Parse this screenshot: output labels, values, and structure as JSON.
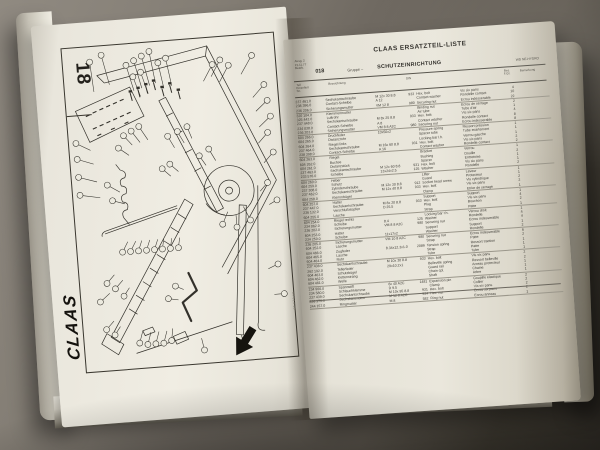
{
  "left_page": {
    "tab_number": "18",
    "brand_logo": "CLAAS",
    "edge_code": "04 013 18"
  },
  "right_page": {
    "title": "CLAAS ERSATZTEIL-LISTE",
    "meta_lines": [
      "Ausg. 2",
      "21.11.77",
      "Bearb."
    ],
    "group_no": "018",
    "group_label": "Gruppe –",
    "group_name": "SCHUTZEINRICHTUNG",
    "right_ref": "WD NE-HYDRO",
    "table": {
      "col_headers": {
        "part_no_lines": [
          "Teil",
          "Einzelteil",
          "Nr."
        ],
        "description": "Bezeichnung",
        "din": "DIN",
        "qty_lines": [
          "Bes.",
          "F.Gr."
        ],
        "remark": "Bemerkung"
      },
      "rows": [
        {
          "nr": "237 461.0",
          "de": "Sechskantschraube",
          "dim": "M 12x 30 8.8",
          "din": "933",
          "en": "Hex. bolt",
          "fr": "Vis six pans",
          "qty": "4",
          "rem": ""
        },
        {
          "nr": "238 396.0",
          "de": "Contact-Scheibe",
          "dim": "A 12",
          "din": "",
          "en": "Contact washer",
          "fr": "Rondelle contact",
          "qty": "10",
          "rem": ""
        },
        {
          "nr": "236 206.0",
          "de": "Sicherungsmutter",
          "dim": "VM 12 8",
          "din": "980",
          "en": "Securing nut",
          "fr": "Ecrou indesserable",
          "qty": "22",
          "rem": "",
          "hr": true
        },
        {
          "nr": "320 104.0",
          "de": "Klemmenmutter",
          "dim": "",
          "din": "",
          "en": "Binding nut",
          "fr": "Ecrou de serrage",
          "qty": "2",
          "rem": ""
        },
        {
          "nr": "325 442.0",
          "de": "Luftrohr",
          "dim": "",
          "din": "",
          "en": "Air tube",
          "fr": "Tube d'air",
          "qty": "1",
          "rem": ""
        },
        {
          "nr": "237 448.0",
          "de": "Sechskantschraube",
          "dim": "M 8x 25 8.8",
          "din": "933",
          "en": "Hex. bolt",
          "fr": "Vis six pans",
          "qty": "4",
          "rem": ""
        },
        {
          "nr": "234 038.0",
          "de": "Contact-Scheibe",
          "dim": "A 8",
          "din": "",
          "en": "Contact washer",
          "fr": "Rondelle contact",
          "qty": "8",
          "rem": ""
        },
        {
          "nr": "236 203.0",
          "de": "Sicherungsmutter",
          "dim": "VM 8 8 A2C",
          "din": "980",
          "en": "Securing nut",
          "fr": "Ecrou indesserable",
          "qty": "8",
          "rem": "",
          "hr": true
        },
        {
          "nr": "604 266.0",
          "de": "Druckfeder",
          "dim": "10x50x2",
          "din": "",
          "en": "Pressure spring",
          "fr": "Ressort pression",
          "qty": "1",
          "rem": ""
        },
        {
          "nr": "604 265.0",
          "de": "Distanzrohr",
          "dim": "",
          "din": "",
          "en": "Spacer tube",
          "fr": "Tube ecartement",
          "qty": "1",
          "rem": ""
        },
        {
          "nr": "604 264.0",
          "de": "Riegel links",
          "dim": "",
          "din": "",
          "en": "Locking bar l.h.",
          "fr": "Verrou gauche",
          "qty": "1",
          "rem": ""
        },
        {
          "nr": "237 464.0",
          "de": "Sechskantschraube",
          "dim": "M 16x 60 8.8",
          "din": "931",
          "en": "Hex. bolt",
          "fr": "Vis six pans",
          "qty": "2",
          "rem": ""
        },
        {
          "nr": "238 398.0",
          "de": "Contact-Scheibe",
          "dim": "A 16",
          "din": "",
          "en": "Contact washer",
          "fr": "Rondelle contact",
          "qty": "2",
          "rem": "",
          "hr": true
        },
        {
          "nr": "604 263.0",
          "de": "Riegel",
          "dim": "",
          "din": "",
          "en": "Bracket",
          "fr": "Verrou",
          "qty": "1",
          "rem": ""
        },
        {
          "nr": "604 262.0",
          "de": "Buchse",
          "dim": "",
          "din": "",
          "en": "Bushing",
          "fr": "Douille",
          "qty": "2",
          "rem": ""
        },
        {
          "nr": "604 261.0",
          "de": "Distanzstück",
          "dim": "",
          "din": "",
          "en": "Spacer",
          "fr": "Entretoise",
          "qty": "1",
          "rem": ""
        },
        {
          "nr": "237 463.0",
          "de": "Sechskantschraube",
          "dim": "M 12x 60 8.8",
          "din": "931",
          "en": "Hex. bolt",
          "fr": "Vis six pans",
          "qty": "1",
          "rem": ""
        },
        {
          "nr": "233 576.0",
          "de": "Scheibe",
          "dim": "13x24x2.5",
          "din": "125",
          "en": "Washer",
          "fr": "Rondelle",
          "qty": "2",
          "rem": "",
          "hr": true
        },
        {
          "nr": "604 260.0",
          "de": "Heber",
          "dim": "",
          "din": "",
          "en": "Lifter",
          "fr": "Leveur",
          "qty": "1",
          "rem": ""
        },
        {
          "nr": "604 259.0",
          "de": "Schutz",
          "dim": "",
          "din": "",
          "en": "Guard",
          "fr": "Protecteur",
          "qty": "1",
          "rem": ""
        },
        {
          "nr": "237 308.0",
          "de": "Zylinderschraube",
          "dim": "M 12x 30 8.8",
          "din": "912",
          "en": "Socket head screw",
          "fr": "Vis cylindrique",
          "qty": "2",
          "rem": ""
        },
        {
          "nr": "237 462.0",
          "de": "Sechskantschraube",
          "dim": "M 12x 40 8.8",
          "din": "933",
          "en": "Hex. bolt",
          "fr": "Vis six pans",
          "qty": "2",
          "rem": ""
        },
        {
          "nr": "604 258.0",
          "de": "Klemmbügel",
          "dim": "",
          "din": "",
          "en": "Clamp",
          "fr": "Etrier de serrage",
          "qty": "1",
          "rem": "",
          "hr": true
        },
        {
          "nr": "604 257.0",
          "de": "Halter",
          "dim": "",
          "din": "",
          "en": "Support",
          "fr": "Support",
          "qty": "1",
          "rem": ""
        },
        {
          "nr": "237 447.0",
          "de": "Sechskantschraube",
          "dim": "M 8x 20 8.8",
          "din": "933",
          "en": "Hex. bolt",
          "fr": "Vis six pans",
          "qty": "4",
          "rem": ""
        },
        {
          "nr": "236 132.0",
          "de": "Verschlußstopfen",
          "dim": "D 25.5",
          "din": "",
          "en": "Plug",
          "fr": "Bouchon",
          "qty": "2",
          "rem": ""
        },
        {
          "nr": "604 255.0",
          "de": "Lasche",
          "dim": "",
          "din": "",
          "en": "Strap",
          "fr": "Patte",
          "qty": "1",
          "rem": "",
          "hr": true
        },
        {
          "nr": "604 254.0",
          "de": "Riegel rechts",
          "dim": "",
          "din": "",
          "en": "Locking bar r.h.",
          "fr": "Verrou droit",
          "qty": "1",
          "rem": ""
        },
        {
          "nr": "234 062.0",
          "de": "Scheibe",
          "dim": "8.4",
          "din": "125",
          "en": "Washer",
          "fr": "Rondelle",
          "qty": "4",
          "rem": ""
        },
        {
          "nr": "236 202.0",
          "de": "Sicherungsmutter",
          "dim": "VM 8 8 A2C",
          "din": "980",
          "en": "Securing nut",
          "fr": "Ecrou indesserable",
          "qty": "4",
          "rem": ""
        },
        {
          "nr": "604 253.0",
          "de": "Halter",
          "dim": "",
          "din": "",
          "en": "Support",
          "fr": "Support",
          "qty": "1",
          "rem": ""
        },
        {
          "nr": "234 250.0",
          "de": "Scheibe",
          "dim": "11x17x2",
          "din": "",
          "en": "Washer",
          "fr": "Rondelle",
          "qty": "2",
          "rem": "",
          "hr": true
        },
        {
          "nr": "236 205.0",
          "de": "Sicherungsmutter",
          "dim": "VM 10 8 A2C",
          "din": "980",
          "en": "Securing nut",
          "fr": "Ecrou indesserable",
          "qty": "6",
          "rem": ""
        },
        {
          "nr": "604 252.0",
          "de": "Lasche",
          "dim": "",
          "din": "",
          "en": "Strap",
          "fr": "Patte",
          "qty": "2",
          "rem": ""
        },
        {
          "nr": "604 466.0",
          "de": "Zugfeder",
          "dim": "8.34x12.3x1.0",
          "din": "2089",
          "en": "Tension spring",
          "fr": "Ressort traction",
          "qty": "1",
          "rem": ""
        },
        {
          "nr": "604 465.0",
          "de": "Lasche",
          "dim": "",
          "din": "",
          "en": "Strap",
          "fr": "Patte",
          "qty": "1",
          "rem": ""
        },
        {
          "nr": "604 464.0",
          "de": "Rohr",
          "dim": "",
          "din": "",
          "en": "Tube",
          "fr": "Tube",
          "qty": "1",
          "rem": "",
          "hr": true
        },
        {
          "nr": "237 438.0",
          "de": "Sechskantschraube",
          "dim": "M 10x 30 8.8",
          "din": "933",
          "en": "Hex. bolt",
          "fr": "Vis six pans",
          "qty": "2",
          "rem": ""
        },
        {
          "nr": "262 192.0",
          "de": "Tellerfeder",
          "dim": "29x10.2x1",
          "din": "",
          "en": "Belleville spring",
          "fr": "Ressort belleville",
          "qty": "2",
          "rem": ""
        },
        {
          "nr": "604 463.0",
          "de": "Schutzbügel",
          "dim": "",
          "din": "",
          "en": "Guard rail",
          "fr": "Arceau protecteur",
          "qty": "1",
          "rem": ""
        },
        {
          "nr": "604 462.0",
          "de": "Kettenstrang",
          "dim": "",
          "din": "",
          "en": "Chain cpl.",
          "fr": "Chaine",
          "qty": "1",
          "rem": ""
        },
        {
          "nr": "604 461.0",
          "de": "Welle",
          "dim": "",
          "din": "",
          "en": "Shaft",
          "fr": "Arbre",
          "qty": "1",
          "rem": "",
          "hr": true
        },
        {
          "nr": "234 966.0",
          "de": "Spannstift",
          "dim": "6x 40 A2C",
          "din": "1481",
          "en": "Expansion pin",
          "fr": "Goupille elastique",
          "qty": "2",
          "rem": ""
        },
        {
          "nr": "234 580.0",
          "de": "Schlauchklemme",
          "dim": "D 9.5",
          "din": "",
          "en": "Clamp",
          "fr": "Collier",
          "qty": "2",
          "rem": ""
        },
        {
          "nr": "237 439.0",
          "de": "Sechskantschraube",
          "dim": "M 10x 95 8.8",
          "din": "931",
          "en": "Hex. bolt",
          "fr": "Vis six pans",
          "qty": "2",
          "rem": ""
        },
        {
          "nr": "236 173.0",
          "de": "Sechskantmutter",
          "dim": "M 12 8 A2C",
          "din": "934",
          "en": "Hex. nut",
          "fr": "Ecrou six pans",
          "qty": "2",
          "rem": ""
        },
        {
          "nr": "244 157.0",
          "de": "Ringmutter",
          "dim": "M 8",
          "din": "582",
          "en": "Ring nut",
          "fr": "Ecrou anneau",
          "qty": "1",
          "rem": "",
          "hr": true
        }
      ]
    }
  }
}
